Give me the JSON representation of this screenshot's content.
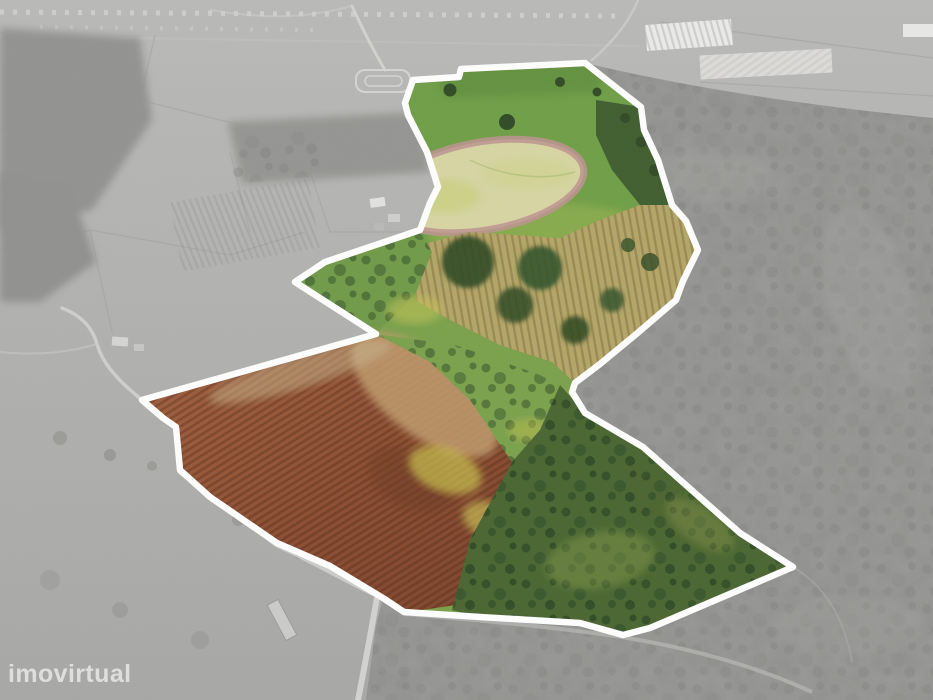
{
  "meta": {
    "type": "aerial-property-photo",
    "description": "Drone aerial photograph of rural land. The surrounding countryside is rendered in desaturated grayscale while the advertised land parcel is shown in full colour and outlined with a thick white boundary polygon.",
    "canvas": {
      "width": 933,
      "height": 700
    }
  },
  "watermark": {
    "text": "imovirtual"
  },
  "property_overlay": {
    "boundary_color": "#ffffff",
    "boundary_stroke_px": 6.5,
    "style": "white polygon outline, colour inside / grayscale outside"
  },
  "regions": {
    "meadow": "bright green grass field (top of parcel)",
    "pale_field": "pale yellow harvested patch with pink-brown tilled rim",
    "terraced_grove": "tan terraced slope with olive/oak tree rows (right)",
    "plowed_field": "red-brown ploughed field with furrow rows (lower left)",
    "scrubland": "dark green dense scrub and trees (lower right)",
    "exterior": "grayscale farmland, village strip, industrial sheds, forest"
  },
  "palette": {
    "meadow_green": "#6f9e45",
    "meadow_light": "#8fae4e",
    "meadow_dark": "#5e8c3c",
    "pale_field": "#d7d5a2",
    "pale_field_rim": "#bd9390",
    "terrace_tan": "#b4a566",
    "tree_dark_green": "#2e4a23",
    "scrub_green": "#49652f",
    "mid_green": "#79a14a",
    "yellow_bloom": "#cfc94f",
    "tan_transition": "#c09b6c",
    "background_gray_light": "#b7b7b5",
    "background_gray": "#a9a9a7",
    "forest_gray": "#8f8f8d",
    "road_gray": "#d6d6d4",
    "building_white": "#ebebe9"
  }
}
